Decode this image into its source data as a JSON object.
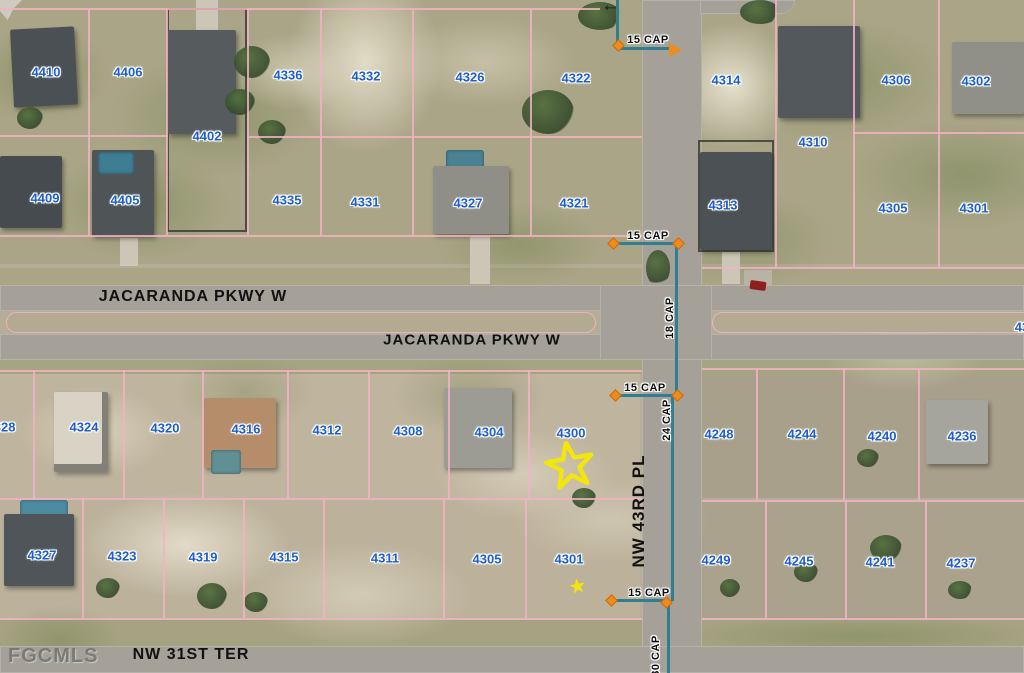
{
  "watermark": "FGCMLS",
  "colors": {
    "parcel_label_blue": "#1d5ecb",
    "parcel_line_pink": "#f3b2c4",
    "utility_line_teal": "#2f7f90",
    "junction_marker_orange": "#ef8a1c",
    "subject_star_yellow": "#f2e60a",
    "street_label_black": "#111111",
    "road_gray": "#a5a198"
  },
  "street_labels": [
    {
      "name": "jacaranda-pkwy-w-north",
      "text": "JACARANDA PKWY W",
      "x": 193,
      "y": 297,
      "size": 16,
      "rotate": 0
    },
    {
      "name": "jacaranda-pkwy-w-south",
      "text": "JACARANDA PKWY W",
      "x": 472,
      "y": 340,
      "size": 15,
      "rotate": 0
    },
    {
      "name": "nw-43rd-pl",
      "text": "NW 43RD PL",
      "x": 639,
      "y": 511,
      "size": 17,
      "rotate": -90
    },
    {
      "name": "nw-31st-ter",
      "text": "NW 31ST TER",
      "x": 191,
      "y": 655,
      "size": 16,
      "rotate": 0
    }
  ],
  "parcel_labels": [
    {
      "text": "4410",
      "x": 46,
      "y": 72
    },
    {
      "text": "4406",
      "x": 128,
      "y": 72
    },
    {
      "text": "4402",
      "x": 207,
      "y": 136
    },
    {
      "text": "4336",
      "x": 288,
      "y": 75
    },
    {
      "text": "4332",
      "x": 366,
      "y": 76
    },
    {
      "text": "4326",
      "x": 470,
      "y": 77
    },
    {
      "text": "4322",
      "x": 576,
      "y": 78
    },
    {
      "text": "4409",
      "x": 45,
      "y": 198
    },
    {
      "text": "4405",
      "x": 125,
      "y": 200
    },
    {
      "text": "4335",
      "x": 287,
      "y": 200
    },
    {
      "text": "4331",
      "x": 365,
      "y": 202
    },
    {
      "text": "4327",
      "x": 468,
      "y": 203
    },
    {
      "text": "4321",
      "x": 574,
      "y": 203
    },
    {
      "text": "4314",
      "x": 726,
      "y": 80
    },
    {
      "text": "4306",
      "x": 896,
      "y": 80
    },
    {
      "text": "4302",
      "x": 976,
      "y": 81
    },
    {
      "text": "4310",
      "x": 813,
      "y": 142
    },
    {
      "text": "4313",
      "x": 723,
      "y": 205
    },
    {
      "text": "4305",
      "x": 893,
      "y": 208
    },
    {
      "text": "4301",
      "x": 974,
      "y": 208
    },
    {
      "text": "4328",
      "x": 1,
      "y": 427
    },
    {
      "text": "4324",
      "x": 84,
      "y": 427
    },
    {
      "text": "4320",
      "x": 165,
      "y": 428
    },
    {
      "text": "4316",
      "x": 246,
      "y": 429
    },
    {
      "text": "4312",
      "x": 327,
      "y": 430
    },
    {
      "text": "4308",
      "x": 408,
      "y": 431
    },
    {
      "text": "4304",
      "x": 489,
      "y": 432
    },
    {
      "text": "4300",
      "x": 571,
      "y": 433
    },
    {
      "text": "4248",
      "x": 719,
      "y": 434
    },
    {
      "text": "4244",
      "x": 802,
      "y": 434
    },
    {
      "text": "4240",
      "x": 882,
      "y": 436
    },
    {
      "text": "4236",
      "x": 962,
      "y": 436
    },
    {
      "text": "43",
      "x": 1022,
      "y": 327
    },
    {
      "text": "4327",
      "x": 42,
      "y": 555
    },
    {
      "text": "4323",
      "x": 122,
      "y": 556
    },
    {
      "text": "4319",
      "x": 203,
      "y": 557
    },
    {
      "text": "4315",
      "x": 284,
      "y": 557
    },
    {
      "text": "4311",
      "x": 385,
      "y": 558
    },
    {
      "text": "4305",
      "x": 487,
      "y": 559
    },
    {
      "text": "4301",
      "x": 569,
      "y": 559
    },
    {
      "text": "4249",
      "x": 716,
      "y": 560
    },
    {
      "text": "4245",
      "x": 799,
      "y": 561
    },
    {
      "text": "4241",
      "x": 880,
      "y": 562
    },
    {
      "text": "4237",
      "x": 961,
      "y": 563
    }
  ],
  "utility_labels": [
    {
      "text": "15 CAP",
      "x": 648,
      "y": 40,
      "rotate": 0
    },
    {
      "text": "15 CAP",
      "x": 648,
      "y": 236,
      "rotate": 0
    },
    {
      "text": "18 CAP",
      "x": 670,
      "y": 318,
      "rotate": -90
    },
    {
      "text": "15 CAP",
      "x": 645,
      "y": 388,
      "rotate": 0
    },
    {
      "text": "24 CAP",
      "x": 667,
      "y": 420,
      "rotate": -90
    },
    {
      "text": "15 CAP",
      "x": 649,
      "y": 593,
      "rotate": 0
    },
    {
      "text": "30 CAP",
      "x": 656,
      "y": 656,
      "rotate": -90
    }
  ],
  "utility_lines": {
    "vertical": [
      [
        616,
        0,
        46
      ],
      [
        675,
        244,
        152
      ],
      [
        671,
        396,
        205
      ],
      [
        667,
        602,
        71
      ]
    ],
    "horizontal": [
      [
        617,
        47,
        56
      ],
      [
        612,
        242,
        68
      ],
      [
        612,
        394,
        66
      ],
      [
        608,
        599,
        60
      ]
    ]
  },
  "junction_markers": [
    {
      "x": 618,
      "y": 45
    },
    {
      "x": 613,
      "y": 243
    },
    {
      "x": 678,
      "y": 243
    },
    {
      "x": 615,
      "y": 395
    },
    {
      "x": 677,
      "y": 395
    },
    {
      "x": 611,
      "y": 600
    },
    {
      "x": 666,
      "y": 602
    }
  ],
  "flow_arrows": [
    {
      "type": "orange-right",
      "x": 669,
      "y": 43
    },
    {
      "type": "black-left",
      "x": 601,
      "y": -5
    }
  ],
  "subject_markers": [
    {
      "type": "star-outline",
      "x": 570,
      "y": 466,
      "size": 50
    },
    {
      "type": "star-filled",
      "x": 577,
      "y": 586,
      "size": 17
    }
  ],
  "parcel_lines": {
    "horizontal": [
      [
        0,
        8,
        600
      ],
      [
        0,
        135,
        168
      ],
      [
        247,
        136,
        395
      ],
      [
        853,
        132,
        171
      ],
      [
        0,
        235,
        642
      ],
      [
        702,
        267,
        322
      ],
      [
        0,
        370,
        642
      ],
      [
        702,
        368,
        322
      ],
      [
        0,
        498,
        642
      ],
      [
        702,
        500,
        322
      ],
      [
        0,
        618,
        642
      ],
      [
        702,
        618,
        322
      ]
    ],
    "vertical": [
      [
        88,
        10,
        225
      ],
      [
        166,
        8,
        227
      ],
      [
        247,
        8,
        227
      ],
      [
        320,
        8,
        227
      ],
      [
        412,
        10,
        225
      ],
      [
        530,
        10,
        225
      ],
      [
        775,
        0,
        267
      ],
      [
        853,
        0,
        267
      ],
      [
        938,
        0,
        267
      ],
      [
        33,
        370,
        128
      ],
      [
        123,
        370,
        128
      ],
      [
        202,
        370,
        128
      ],
      [
        287,
        370,
        128
      ],
      [
        368,
        370,
        128
      ],
      [
        448,
        370,
        128
      ],
      [
        528,
        370,
        128
      ],
      [
        756,
        368,
        132
      ],
      [
        843,
        368,
        132
      ],
      [
        918,
        368,
        132
      ],
      [
        82,
        498,
        120
      ],
      [
        163,
        498,
        120
      ],
      [
        243,
        498,
        120
      ],
      [
        323,
        498,
        120
      ],
      [
        443,
        498,
        120
      ],
      [
        525,
        498,
        120
      ],
      [
        765,
        500,
        118
      ],
      [
        845,
        500,
        118
      ],
      [
        925,
        500,
        118
      ]
    ]
  }
}
